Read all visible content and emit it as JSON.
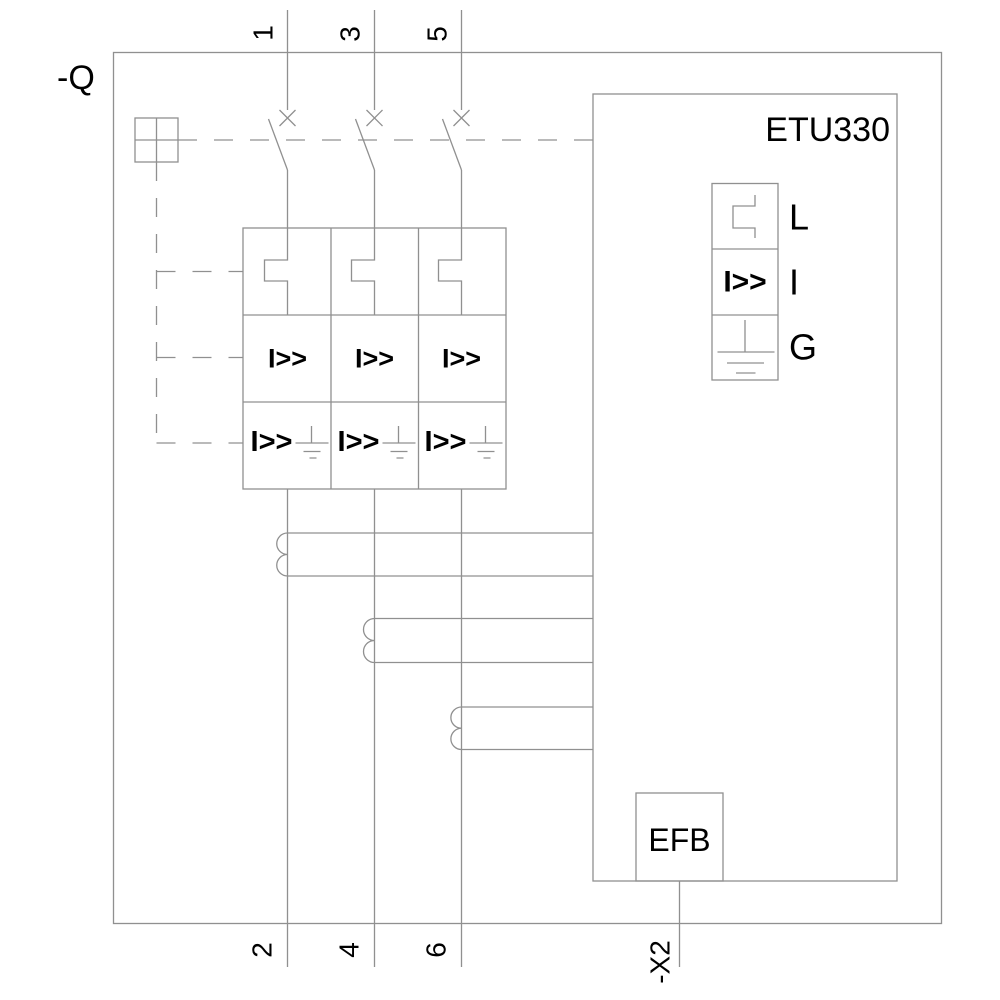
{
  "colors": {
    "line": "#909090",
    "text": "#000000",
    "background": "#ffffff"
  },
  "device": {
    "designation": "-Q",
    "trip_unit": "ETU330",
    "earth_fault_module": "EFB",
    "terminal_block": "-X2"
  },
  "terminals": {
    "top": [
      "1",
      "3",
      "5"
    ],
    "bottom": [
      "2",
      "4",
      "6"
    ]
  },
  "protection": {
    "instantaneous_symbol": "I>>",
    "legend": [
      {
        "label": "L",
        "icon": "long-time-curve-icon"
      },
      {
        "label": "I",
        "symbol": "I>>"
      },
      {
        "label": "G",
        "icon": "earth-icon"
      }
    ]
  }
}
